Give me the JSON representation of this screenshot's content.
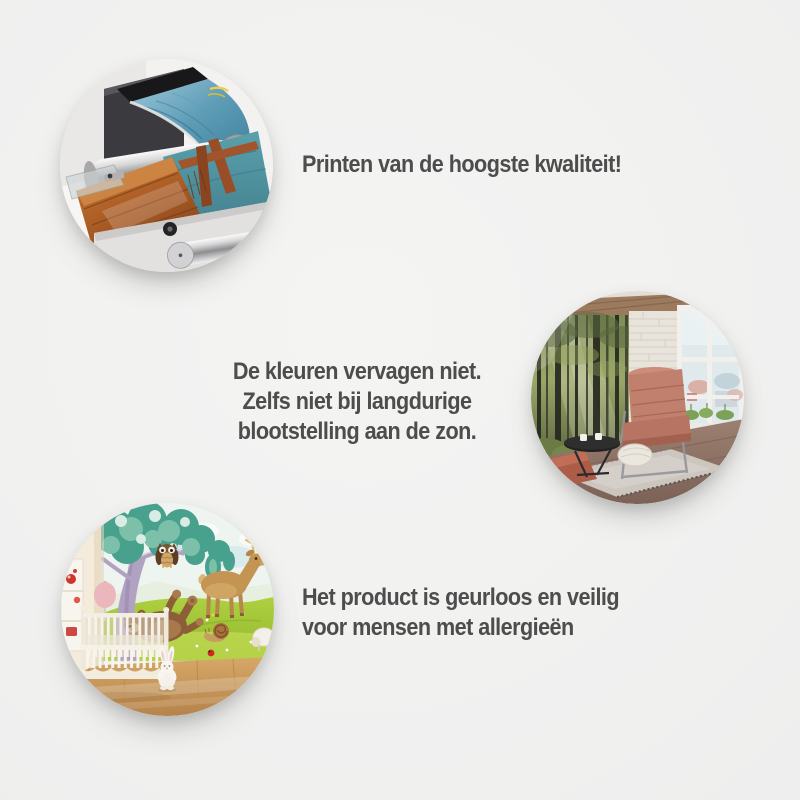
{
  "page": {
    "background_color": "#f1f1f1",
    "text_color": "#4d4d4d"
  },
  "features": [
    {
      "photo": "printing-machine-photo",
      "lines": [
        "Printen van de hoogste kwaliteit!"
      ]
    },
    {
      "photo": "living-room-forest-wall-mural-photo",
      "lines": [
        "De kleuren vervagen niet.",
        "Zelfs niet bij langdurige",
        "blootstelling aan de zon."
      ]
    },
    {
      "photo": "nursery-cartoon-animals-wall-mural-photo",
      "lines": [
        "Het product is geurloos en veilig",
        "voor mensen met allergieën"
      ]
    }
  ]
}
